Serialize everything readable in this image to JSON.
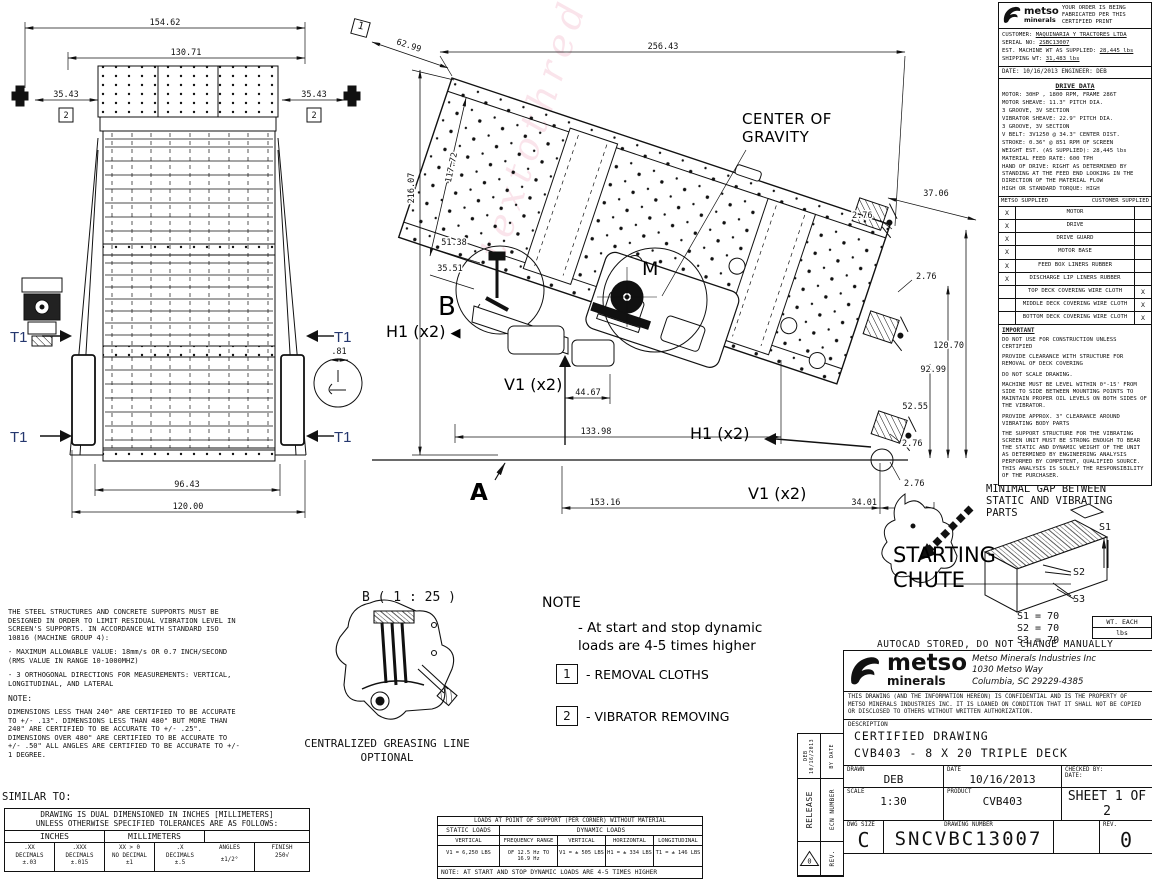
{
  "watermark": "textothreduce",
  "front_view": {
    "d154": "154.62",
    "d130": "130.71",
    "d35": "35.43",
    "d96": "96.43",
    "d120": "120.00",
    "d81": ".81",
    "callout": "2",
    "t1": "T1"
  },
  "side_view": {
    "labels": {
      "cog": "CENTER OF GRAVITY",
      "b": "B",
      "m": "M",
      "a": "A",
      "h1": "H1 (x2)",
      "v1": "V1 (x2)"
    },
    "arrow_left": "◀",
    "callout": "1",
    "dims": {
      "d62": "62.99",
      "d256": "256.43",
      "d216": "216.07",
      "d117": "117.72",
      "d51": "51.38",
      "d3551": "35.51",
      "d44": "44.67",
      "d133": "133.98",
      "d153": "153.16",
      "d34": "34.01",
      "d37": "37.06",
      "d276": "2.76",
      "d120": "120.70",
      "d92": "92.99",
      "d52": "52.55"
    }
  },
  "order_block": {
    "logo": "metso",
    "logo_sub": "minerals",
    "note": "YOUR ORDER IS BEING FABRICATED PER THIS CERTIFIED PRINT",
    "customer_label": "CUSTOMER:",
    "customer": "MAQUINARIA Y TRACTORES LTDA",
    "serial_label": "SERIAL NO:",
    "serial": "2SBC13007",
    "est_label": "EST. MACHINE WT AS SUPPLIED:",
    "est": "28,445 lbs",
    "ship_label": "SHIPPING WT:",
    "ship": "31,483 lbs",
    "date_line": "DATE: 10/16/2013   ENGINEER: DEB"
  },
  "drive_data": {
    "title": "DRIVE DATA",
    "lines": [
      "MOTOR: 30HP , 1800 RPM, FRAME 286T",
      "MOTOR SHEAVE: 11.3\" PITCH DIA.",
      "        3 GROOVE, 3V SECTION",
      "VIBRATOR SHEAVE: 22.9\" PITCH DIA.",
      "        3 GROOVE, 3V SECTION",
      "V BELT: 3V1250 @ 34.3\" CENTER DIST.",
      "STROKE: 0.36\" @ 851 RPM OF SCREEN",
      "WEIGHT EST. (AS SUPPLIED): 28,445 lbs",
      "MATERIAL FEED RATE: 600 TPH",
      "HAND OF DRIVE: RIGHT  AS DETERMINED BY STANDING AT THE FEED END LOOKING IN THE DIRECTION OF THE MATERIAL FLOW",
      "HIGH OR STANDARD TORQUE: HIGH"
    ]
  },
  "supply_table": {
    "col_left": "METSO SUPPLIED",
    "col_right": "CUSTOMER SUPPLIED",
    "rows": [
      {
        "metso": "X",
        "item": "MOTOR",
        "customer": ""
      },
      {
        "metso": "X",
        "item": "DRIVE",
        "customer": ""
      },
      {
        "metso": "X",
        "item": "DRIVE GUARD",
        "customer": ""
      },
      {
        "metso": "X",
        "item": "MOTOR BASE",
        "customer": ""
      },
      {
        "metso": "X",
        "item": "FEED BOX LINERS RUBBER",
        "customer": ""
      },
      {
        "metso": "X",
        "item": "DISCHARGE LIP LINERS RUBBER",
        "customer": ""
      },
      {
        "metso": "",
        "item": "TOP DECK COVERING WIRE CLOTH",
        "customer": "X"
      },
      {
        "metso": "",
        "item": "MIDDLE DECK COVERING WIRE CLOTH",
        "customer": "X"
      },
      {
        "metso": "",
        "item": "BOTTOM DECK COVERING WIRE CLOTH",
        "customer": "X"
      }
    ]
  },
  "important": {
    "title": "IMPORTANT",
    "paragraphs": [
      "DO NOT USE FOR CONSTRUCTION UNLESS CERTIFIED",
      "PROVIDE CLEARANCE WITH STRUCTURE FOR REMOVAL OF DECK COVERING",
      "DO NOT SCALE DRAWING.",
      "MACHINE MUST BE LEVEL WITHIN 0°-15' FROM SIDE TO SIDE BETWEEN MOUNTING POINTS TO MAINTAIN PROPER OIL LEVELS ON BOTH SIDES OF THE VIBRATOR.",
      "PROVIDE APPROX. 3\" CLEARANCE AROUND VIBRATING BODY PARTS",
      "THE SUPPORT STRUCTURE FOR THE VIBRATING SCREEN UNIT MUST BE STRONG ENOUGH TO BEAR THE STATIC AND DYNAMIC WEIGHT OF THE UNIT AS DETERMINED BY ENGINEERING ANALYSIS PERFORMED BY COMPETENT, QUALIFIED SOURCE. THIS ANALYSIS IS SOLELY THE RESPONSIBILITY OF THE PURCHASER."
    ]
  },
  "notes_left": {
    "paragraphs": [
      "THE STEEL STRUCTURES AND CONCRETE SUPPORTS MUST BE DESIGNED IN ORDER TO LIMIT RESIDUAL VIBRATION LEVEL IN SCREEN'S SUPPORTS. IN ACCORDANCE WITH STANDARD ISO 10816 (MACHINE GROUP 4):",
      "- MAXIMUM ALLOWABLE VALUE: 18mm/s OR 0.7 INCH/SECOND (RMS VALUE IN RANGE 10-1000MHZ)",
      "- 3 ORTHOGONAL DIRECTIONS FOR MEASUREMENTS: VERTICAL, LONGITUDINAL, AND LATERAL"
    ],
    "note_title": "NOTE:",
    "note_body": "DIMENSIONS LESS THAN 240\" ARE CERTIFIED TO BE ACCURATE TO +/- .13\". DIMENSIONS LESS THAN 480\" BUT MORE THAN 240\" ARE CERTIFIED TO BE ACCURATE TO +/- .25\". DIMENSIONS OVER 480\" ARE CERTIFIED TO BE ACCURATE TO +/- .50\" ALL ANGLES ARE CERTIFIED TO BE ACCURATE TO +/- 1 DEGREE.",
    "similar_to": "SIMILAR TO:"
  },
  "tolerance_table": {
    "header1": "DRAWING IS DUAL DIMENSIONED IN  INCHES [MILLIMETERS]",
    "header2": "UNLESS OTHERWISE SPECIFIED TOLERANCES ARE AS FOLLOWS:",
    "inches_label": "INCHES",
    "mm_label": "MILLIMETERS",
    "cells": [
      {
        "l1": ".XX",
        "l2": "DECIMALS",
        "l3": "±.03"
      },
      {
        "l1": ".XXX",
        "l2": "DECIMALS",
        "l3": "±.015"
      },
      {
        "l1": "XX > 0",
        "l2": "NO DECIMAL",
        "l3": "±1"
      },
      {
        "l1": ".X",
        "l2": "DECIMALS",
        "l3": "±.5"
      }
    ],
    "angles_l1": "ANGLES",
    "angles_l2": "±1/2°",
    "finish_l1": "FINISH",
    "finish_l2": "250",
    "finish_symbol": "√"
  },
  "loads_table": {
    "title": "LOADS AT POINT OF SUPPORT (PER CORNER) WITHOUT MATERIAL",
    "static_label": "STATIC LOADS",
    "dynamic_label": "DYNAMIC LOADS",
    "headers": [
      "VERTICAL",
      "FREQUENCY RANGE",
      "VERTICAL",
      "HORIZONTAL",
      "LONGITUDINAL"
    ],
    "values": [
      "V1 = 6,250 LBS",
      "OF 12.5 Hz TO 16.9 Hz",
      "V1 = ± 505 LBS",
      "H1 = ± 334 LBS",
      "T1 = ± 146 LBS"
    ],
    "note": "NOTE:  AT START AND STOP DYNAMIC LOADS ARE 4-5 TIMES HIGHER"
  },
  "center_note": {
    "title": "NOTE",
    "body": "- At start and stop dynamic loads are 4-5 times higher",
    "items": [
      {
        "num": "1",
        "label": "- REMOVAL CLOTHS"
      },
      {
        "num": "2",
        "label": "- VIBRATOR REMOVING"
      }
    ]
  },
  "detail_b": {
    "title": "B ( 1 : 25 )",
    "caption1": "CENTRALIZED GREASING LINE",
    "caption2": "OPTIONAL"
  },
  "chute": {
    "gap_note": "MINIMAL GAP BETWEEN STATIC AND VIBRATING PARTS",
    "title": "STARTING CHUTE",
    "s1": "S1",
    "s2": "S2",
    "s3": "S3",
    "v1": "S1 = 70",
    "v2": "S2 = 70",
    "v3": "S3 = 70",
    "wt_each": "WT. EACH",
    "wt_unit": "lbs",
    "autocad_note": "AUTOCAD STORED, DO NOT CHANGE MANUALLY"
  },
  "title_block": {
    "company": "Metso Minerals Industries Inc",
    "address1": "1030 Metso Way",
    "address2": "Columbia, SC 29229-4385",
    "confidential": "THIS DRAWING (AND THE INFORMATION HEREON) IS CONFIDENTIAL AND IS THE PROPERTY OF METSO MINERALS INDUSTRIES INC. IT IS LOANED ON CONDITION THAT IT SHALL NOT BE COPIED OR DISCLOSED TO OTHERS WITHOUT WRITTEN AUTHORIZATION.",
    "description_label": "DESCRIPTION",
    "description1": "CERTIFIED DRAWING",
    "description2": "CVB403 - 8 X 20 TRIPLE DECK",
    "drawn_label": "DRAWN",
    "drawn": "DEB",
    "date_label": "DATE",
    "date": "10/16/2013",
    "checked_label": "CHECKED BY:",
    "checked_date_label": "DATE:",
    "scale_label": "SCALE",
    "scale": "1:30",
    "product_label": "PRODUCT",
    "product": "CVB403",
    "sheet": "SHEET 1 OF 2",
    "dwg_size_label": "DWG SIZE",
    "dwg_size": "C",
    "drawing_number_label": "DRAWING NUMBER",
    "drawing_number": "SNCVBC13007",
    "rev_label": "REV.",
    "rev": "0",
    "release": "RELEASE",
    "ecn": "ECN NUMBER",
    "by_date": "BY DATE",
    "deb_date": "DEB 10/16/2013",
    "rev_triangle": "0"
  }
}
